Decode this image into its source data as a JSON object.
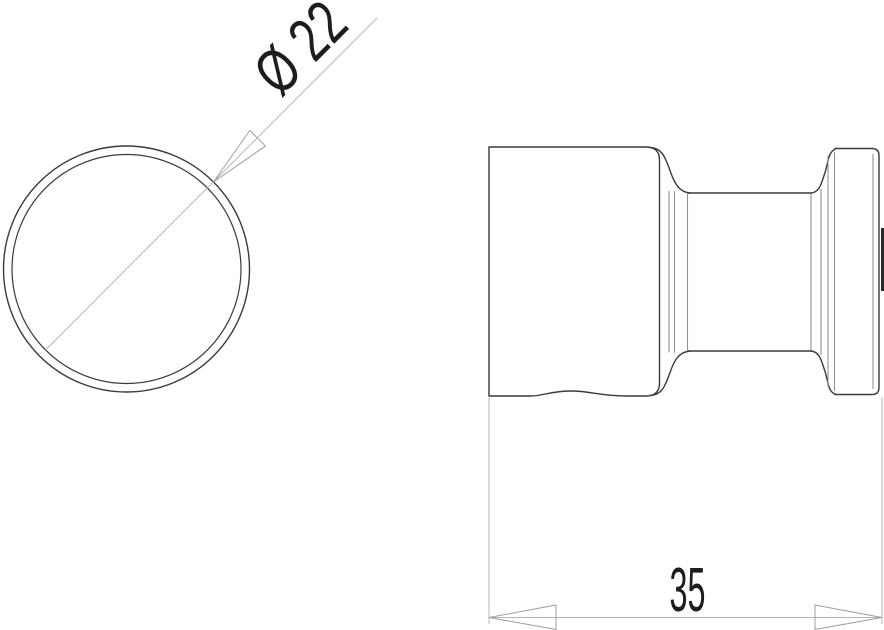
{
  "page": {
    "kind": "technical-drawing",
    "background": "#ffffff"
  },
  "views": {
    "front_view": {
      "shape": "circle-with-inner-edge"
    },
    "side_view": {
      "shape": "knob-profile-with-neck-and-flange"
    }
  },
  "dimensions": {
    "diameter": {
      "label": "Ø 22",
      "value": 22,
      "symbol": "Ø"
    },
    "width": {
      "label": "35",
      "value": 35
    }
  },
  "colors": {
    "outline": "#3a3a3a",
    "inner_edge_line": "#8f8f8f",
    "dimension_line": "#b5b5b5",
    "arrowhead_stroke": "#9e9e9e",
    "text": "#1d1d1d",
    "background": "#ffffff"
  }
}
